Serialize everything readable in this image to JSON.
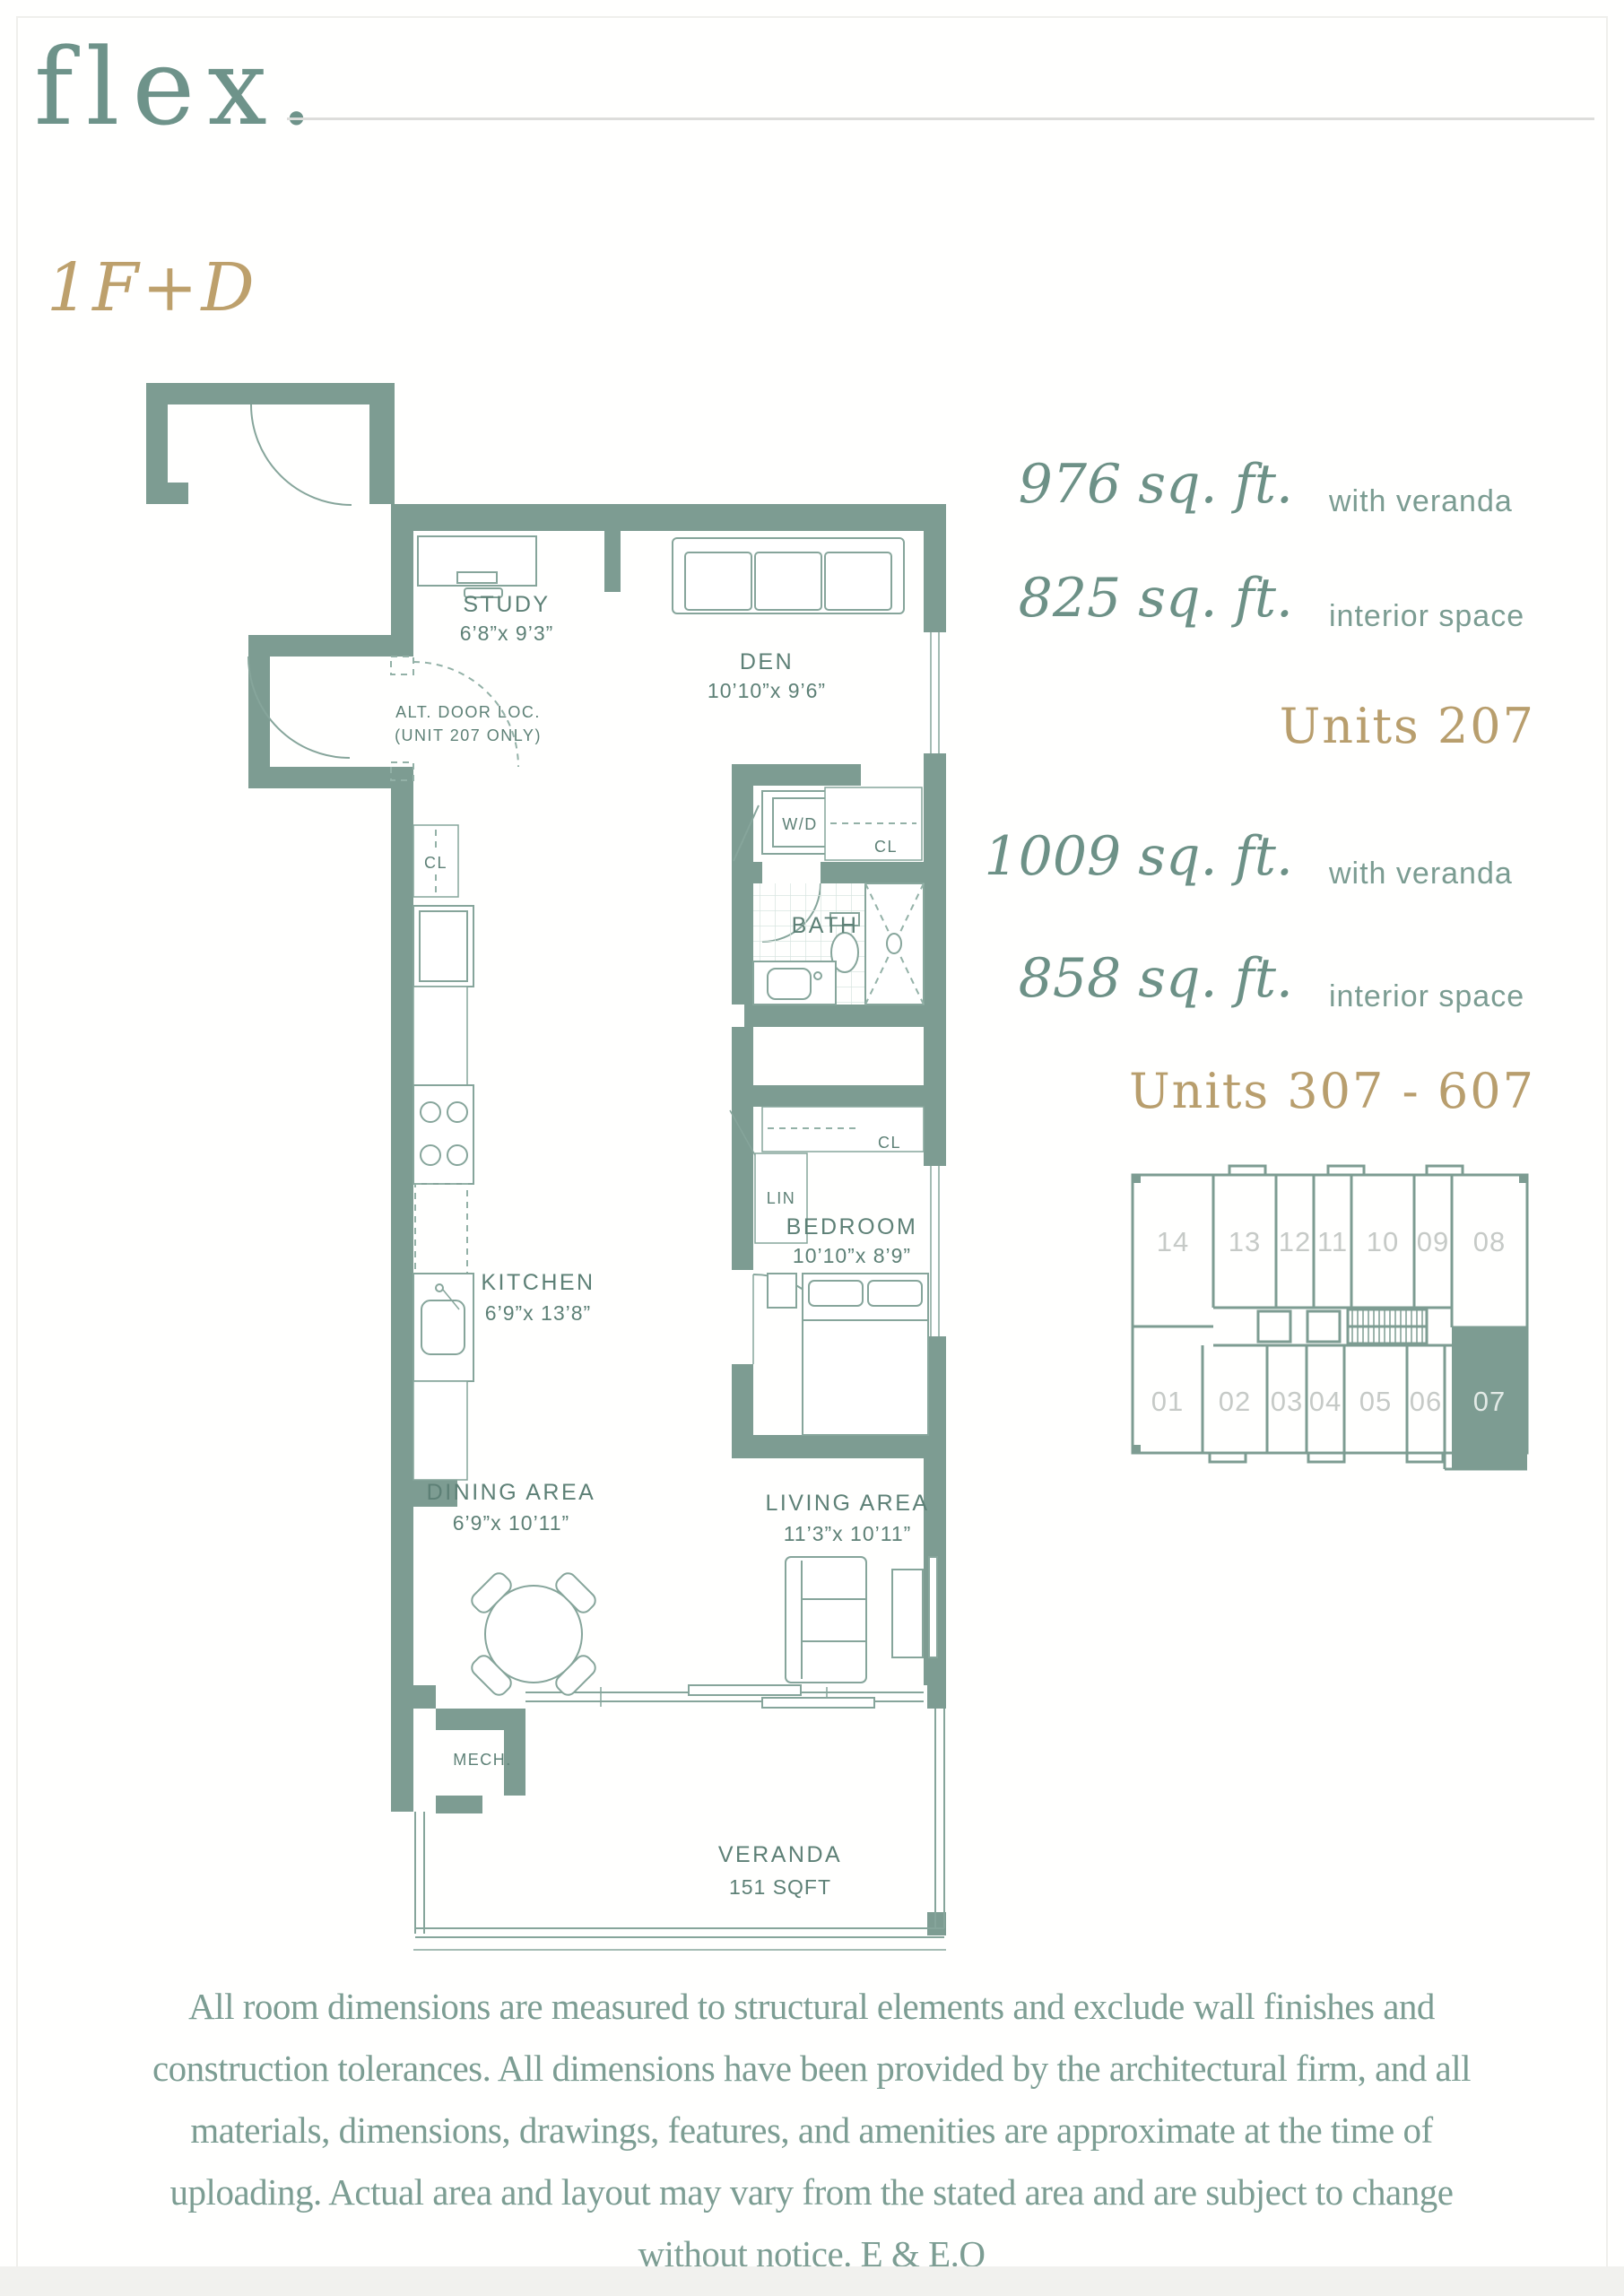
{
  "brand": {
    "logo": "flex."
  },
  "plan": {
    "code": "1F+D"
  },
  "stats": {
    "s207_area": "976 sq. ft.",
    "s207_area_label": "with veranda",
    "s207_interior": "825 sq. ft.",
    "s207_interior_label": "interior space",
    "s207_units": "Units 207",
    "s307_area": "1009 sq. ft.",
    "s307_area_label": "with veranda",
    "s307_interior": "858 sq. ft.",
    "s307_interior_label": "interior space",
    "s307_units": "Units 307 - 607"
  },
  "floorplan": {
    "labels": {
      "study": "STUDY",
      "study_dim": "6’8”x 9’3”",
      "den": "DEN",
      "den_dim": "10’10”x 9’6”",
      "alt_door_1": "ALT. DOOR LOC.",
      "alt_door_2": "(UNIT 207 ONLY)",
      "wd": "W/D",
      "cl": "CL",
      "lin": "LIN",
      "bath": "BATH",
      "kitchen": "KITCHEN",
      "kitchen_dim": "6’9”x 13’8”",
      "bedroom": "BEDROOM",
      "bedroom_dim": "10’10”x 8’9”",
      "dining": "DINING AREA",
      "dining_dim": "6’9”x 10’11”",
      "living": "LIVING AREA",
      "living_dim": "11’3”x 10’11”",
      "mech": "MECH.",
      "veranda": "VERANDA",
      "veranda_area": "151 SQFT"
    }
  },
  "keyplan": {
    "top_units": [
      "14",
      "13",
      "12",
      "11",
      "10",
      "09",
      "08"
    ],
    "bottom_units": [
      "01",
      "02",
      "03",
      "04",
      "05",
      "06",
      "07"
    ],
    "highlighted_unit": "07"
  },
  "disclaimer": "All room dimensions are measured to structural elements and exclude wall finishes and construction tolerances. All dimensions have been provided by the architectural firm, and all materials, dimensions, drawings, features, and amenities are approximate at the time of uploading. Actual area and layout may vary from the stated area and are subject to change without notice. E & E.O",
  "colors": {
    "wall": "#7d9c92",
    "accent_gold": "#b89e6d",
    "teal_text": "#6e938a"
  }
}
